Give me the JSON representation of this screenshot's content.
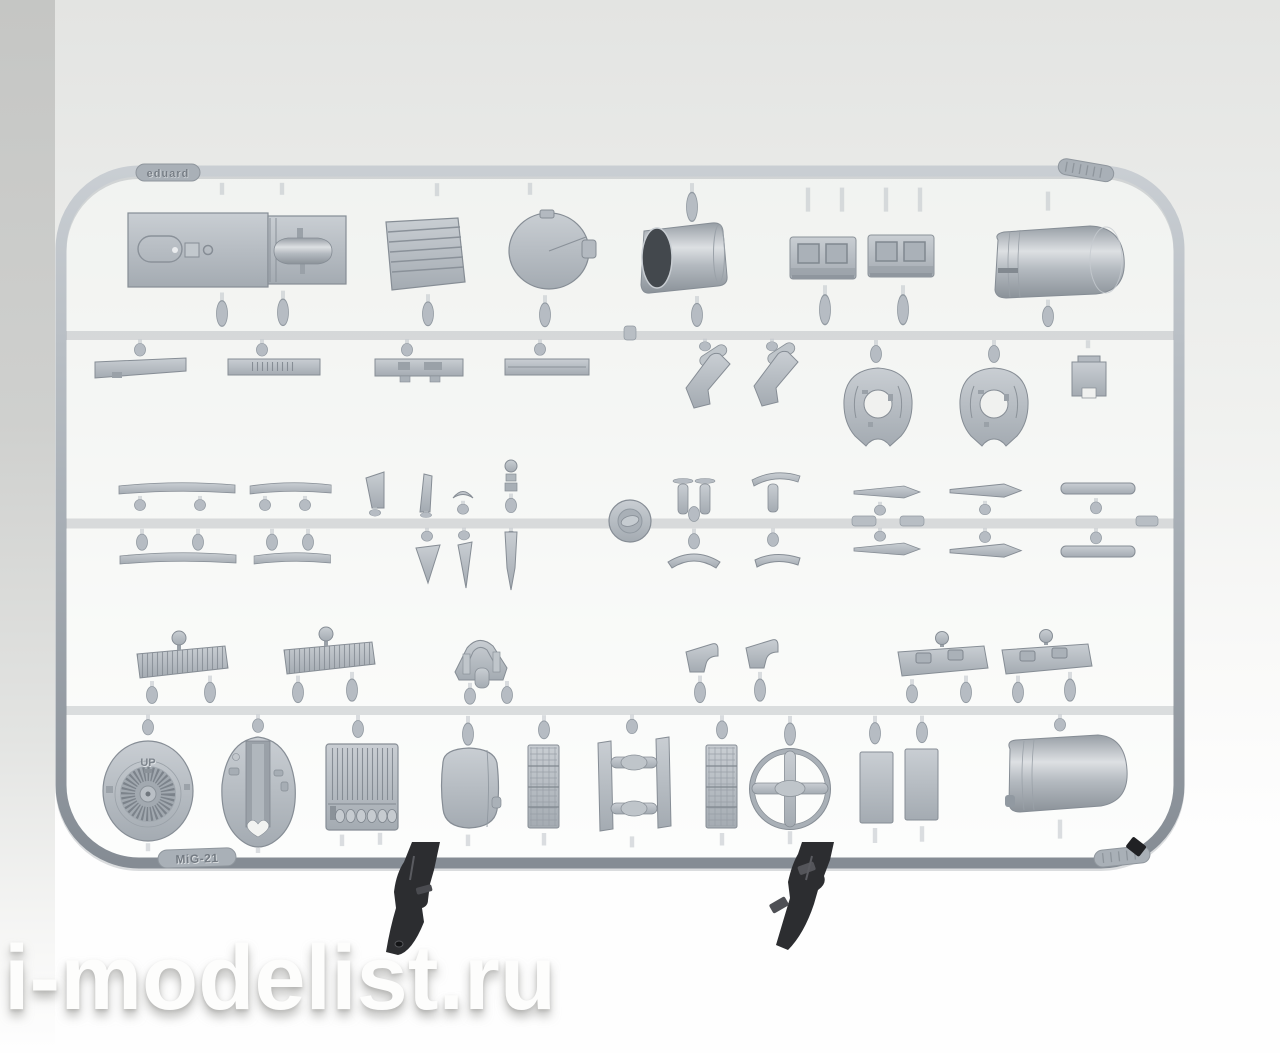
{
  "markings": {
    "brand_tag": "eduard",
    "sprue_tag": "MiG-21",
    "fan_disc_label": "UP"
  },
  "watermark": {
    "text": "i-modelist.ru"
  },
  "colors": {
    "plastic_base": "#b2b9c0",
    "plastic_highlight": "#d8dce0",
    "plastic_shadow": "#878e96",
    "background_top": "#e4e5e3",
    "background_bottom": "#fefefe",
    "left_band": "#c6c7c5",
    "clamp_dark": "#2c2d30",
    "nozzle_bore": "#43484d",
    "watermark_text": "#fdfdfc"
  },
  "parts_inventory": [
    "fuselage-deck-panel",
    "spine-fairing-bullet",
    "louvered-panel",
    "circular-bulkhead-disc",
    "exhaust-nozzle",
    "cockpit-sidewall-panel-1",
    "cockpit-sidewall-panel-2",
    "upper-fuselage-shell",
    "flat-strip-1",
    "flat-strip-2",
    "flat-strip-3",
    "flat-strip-4",
    "v-bracket-1",
    "v-bracket-2",
    "wheel-hub-plate-1",
    "wheel-hub-plate-2",
    "square-bracket",
    "elevator-strip-upper-1",
    "elevator-strip-upper-2",
    "fin-blade",
    "slim-blade",
    "crescent-part",
    "ball-pin",
    "elevator-strip-lower-1",
    "elevator-strip-lower-2",
    "wedge-blade-1",
    "wedge-blade-2",
    "dagger-blade",
    "center-ring-boss",
    "twin-post-cluster",
    "wishbone-link",
    "arc-blade",
    "bent-strip",
    "spear-blade-upper",
    "spear-blade-lower",
    "wing-blade-upper",
    "wing-blade-lower",
    "thick-strip-upper",
    "thick-strip-lower",
    "ribbed-flap-1",
    "ribbed-flap-2",
    "windshield-frame",
    "step-bracket-1",
    "step-bracket-2",
    "latched-hatch-1",
    "latched-hatch-2",
    "engine-fan-disc",
    "gearbox-oval-cover",
    "louvered-box-panel",
    "oval-access-panel",
    "grid-strip-1",
    "h-frame-spindles",
    "grid-strip-2",
    "cross-ring-wheel",
    "rect-panel-1",
    "rect-panel-2",
    "lower-fuselage-shell",
    "black-clamp-left",
    "black-clamp-right",
    "brand-tag",
    "sprue-name-tag",
    "code-tag-top-right",
    "code-tag-bottom-right",
    "paint-mark"
  ]
}
